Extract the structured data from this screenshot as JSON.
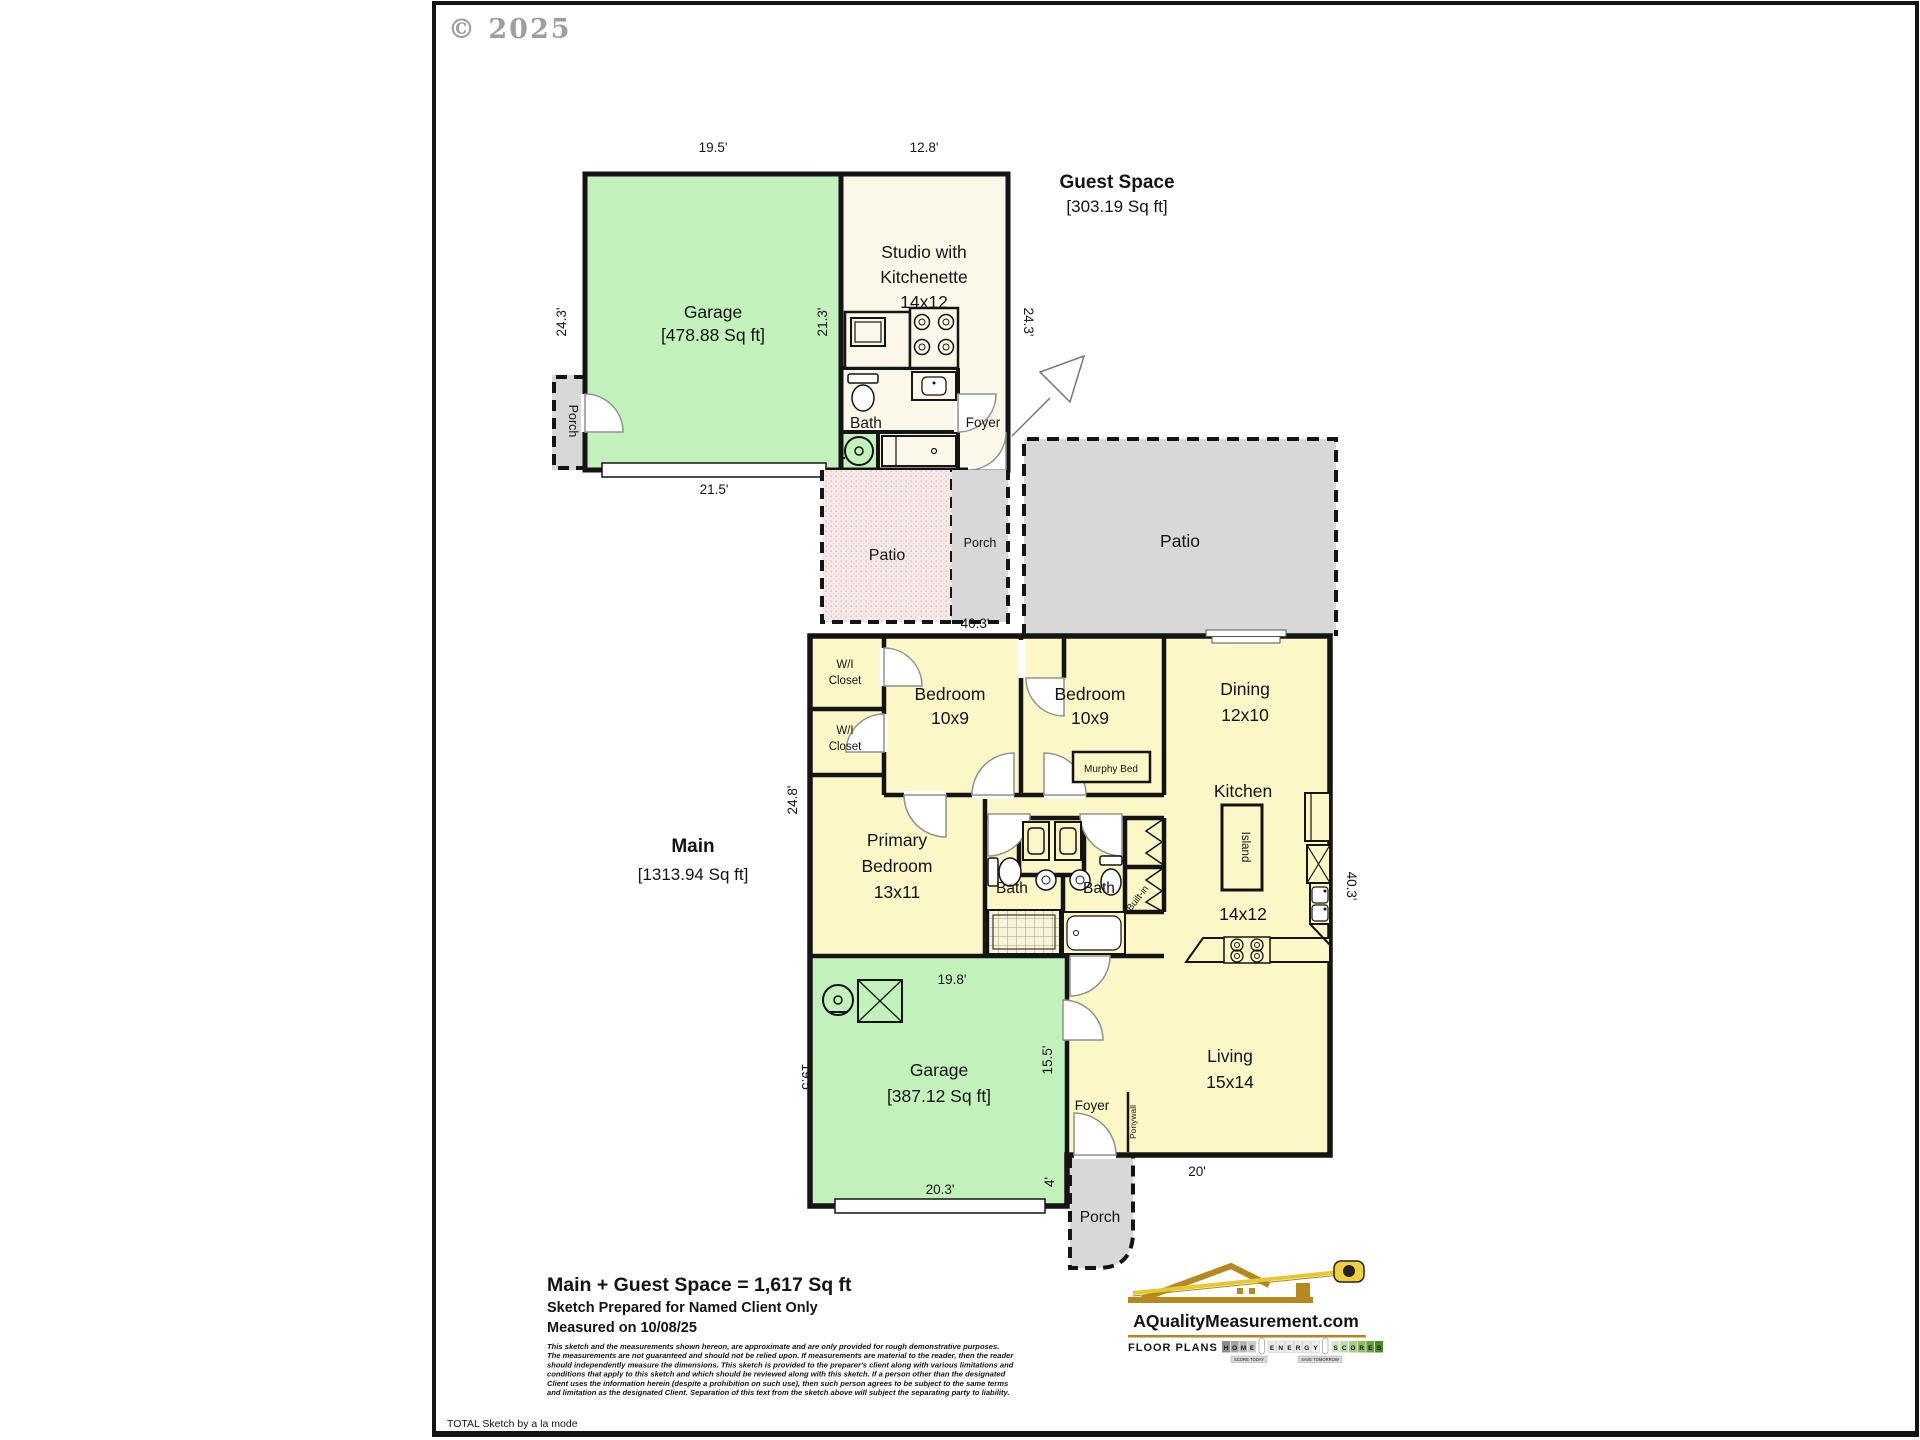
{
  "colors": {
    "wall": "#141414",
    "garage_green": "#c3f1bc",
    "studio_cream": "#fcf8e9",
    "main_yellow": "#fbf7c6",
    "porch_gray": "#d8d8d8",
    "patio_pink": "#f7eaea",
    "logo_navy": "#26266b",
    "logo_gold": "#b6891e"
  },
  "page": {
    "copyright": "© 2025",
    "footer": "TOTAL Sketch by a la mode"
  },
  "guest": {
    "title": "Guest Space",
    "area": "[303.19 Sq ft]",
    "garage": "Garage",
    "garage_area": "[478.88 Sq ft]",
    "studio_l1": "Studio with",
    "studio_l2": "Kitchenette",
    "studio_l3": "14x12",
    "bath": "Bath",
    "foyer": "Foyer",
    "porch": "Porch",
    "dim_garage_top": "19.5'",
    "dim_studio_top": "12.8'",
    "dim_left": "24.3'",
    "dim_garage_inner": "21.3'",
    "dim_right": "24.3'",
    "dim_garage_bottom": "21.5'",
    "dim_patio_top": "10.8'"
  },
  "site": {
    "patio_small": "Patio",
    "porch_small": "Porch",
    "patio_large": "Patio"
  },
  "main": {
    "title": "Main",
    "area": "[1313.94 Sq ft]",
    "dim_top": "40.3'",
    "dim_left": "24.8'",
    "dim_right": "40.3'",
    "closet1_l1": "W/I",
    "closet1_l2": "Closet",
    "closet2_l1": "W/I",
    "closet2_l2": "Closet",
    "bedroom1_l1": "Bedroom",
    "bedroom1_l2": "10x9",
    "bedroom2_l1": "Bedroom",
    "bedroom2_l2": "10x9",
    "murphy": "Murphy Bed",
    "dining_l1": "Dining",
    "dining_l2": "12x10",
    "kitchen": "Kitchen",
    "kitchen_size": "14x12",
    "island": "Island",
    "primary_l1": "Primary",
    "primary_l2": "Bedroom",
    "primary_l3": "13x11",
    "bath_left": "Bath",
    "bath_right": "Bath",
    "builtin": "Built-in",
    "living_l1": "Living",
    "living_l2": "15x14",
    "foyer": "Foyer",
    "ponywall": "Ponywall",
    "garage": "Garage",
    "garage_area": "[387.12 Sq ft]",
    "porch": "Porch",
    "dim_garage_top": "19.8'",
    "dim_garage_left": "19.5'",
    "dim_garage_right": "15.5'",
    "dim_garage_bottom": "20.3'",
    "dim_entry": "4'",
    "dim_living_bottom": "20'"
  },
  "summary": {
    "headline": "Main + Guest Space = 1,617 Sq ft",
    "prepared": "Sketch Prepared for Named Client Only",
    "measured": "Measured on 10/08/25"
  },
  "disclaimer": [
    "This sketch and the measurements shown hereon, are approximate and are only provided for rough demonstrative purposes.",
    "The measurements are not guaranteed and should not be relied upon.  If measurements are material to the reader, then the reader",
    "should independently measure the dimensions.   This sketch is provided to the preparer's client along with various limitations and",
    "conditions that apply to this sketch and which should be reviewed along with this sketch.  If a person other than the designated",
    "Client uses the information herein (despite a prohibition on such use), then such person agrees to be subject to the same terms",
    "and limitation as the designated Client.   Separation of this text from the sketch above will subject the separating party to liability."
  ],
  "logo": {
    "domain": "AQualityMeasurement.com",
    "tagline": "FLOOR PLANS &",
    "home": [
      "H",
      "O",
      "M",
      "E"
    ],
    "energy": [
      "E",
      "N",
      "E",
      "R",
      "G",
      "Y"
    ],
    "scores": [
      "S",
      "C",
      "O",
      "R",
      "E",
      "S"
    ],
    "badge1": "SCORE TODAY",
    "badge2": "SAVE TOMORROW"
  }
}
